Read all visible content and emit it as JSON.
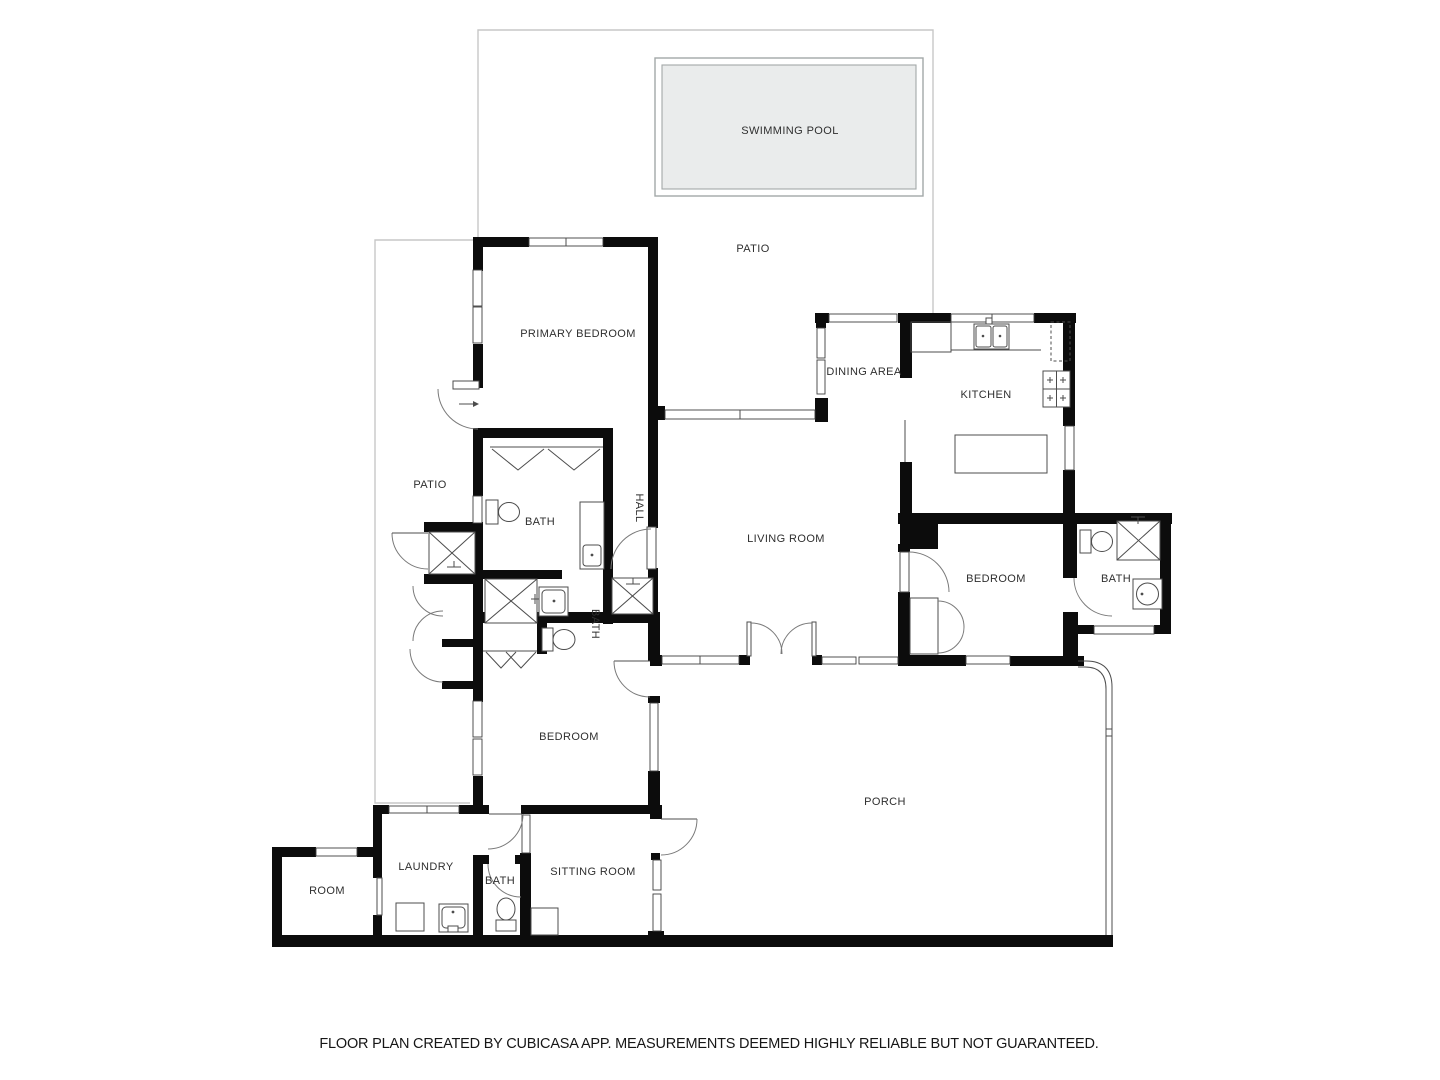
{
  "rooms": {
    "swimming_pool": "SWIMMING POOL",
    "patio_top": "PATIO",
    "patio_left": "PATIO",
    "primary_bedroom": "PRIMARY BEDROOM",
    "dining_area": "DINING AREA",
    "kitchen": "KITCHEN",
    "living_room": "LIVING ROOM",
    "hall": "HALL",
    "primary_bath": "BATH",
    "middle_bath": "BATH",
    "bedroom_right": "BEDROOM",
    "bath_right": "BATH",
    "bedroom_bottom": "BEDROOM",
    "porch": "PORCH",
    "laundry": "LAUNDRY",
    "room": "ROOM",
    "bath_bottom": "BATH",
    "sitting_room": "SITTING ROOM"
  },
  "footer": {
    "disclaimer": "FLOOR PLAN CREATED BY CUBICASA APP. MEASUREMENTS DEEMED HIGHLY RELIABLE BUT NOT GUARANTEED."
  },
  "colors": {
    "wall": "#0c0c0c",
    "pool_fill": "#eaecec",
    "pool_border": "#a3a8a8",
    "patio_outline": "#c7c7c7",
    "text": "#2f2f2f"
  }
}
